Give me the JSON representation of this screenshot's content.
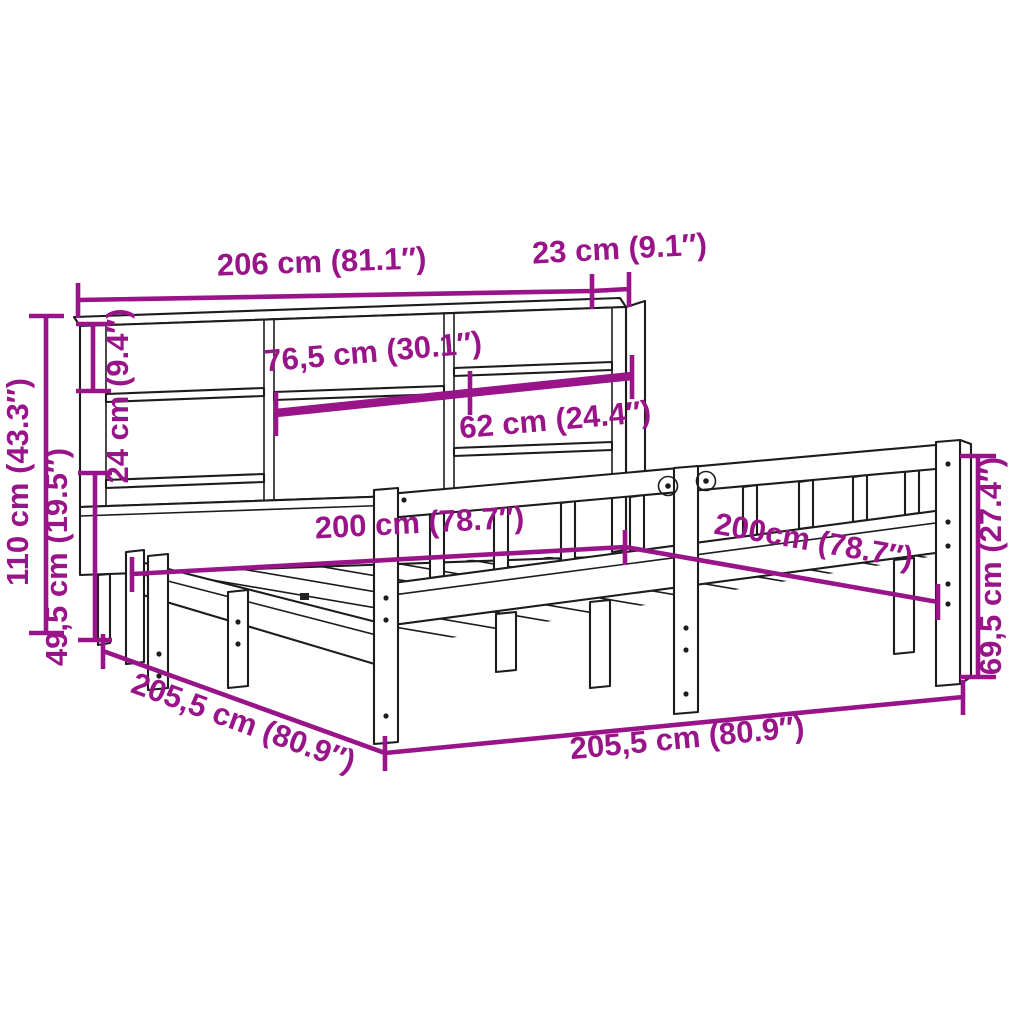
{
  "colors": {
    "background": "#ffffff",
    "outline": "#1c1c1c",
    "dimension": "#9a1489"
  },
  "dims": {
    "bookcase_width": {
      "label": "206 cm (81.1″)"
    },
    "bookcase_depth": {
      "label": "23 cm (9.1″)"
    },
    "shelf_middle_width": {
      "label": "76,5 cm (30.1″)"
    },
    "shelf_right_width": {
      "label": "62 cm (24.4″)"
    },
    "shelf_spacing_height": {
      "label": "24 cm (9.4″)"
    },
    "headboard_total_height": {
      "label": "110 cm (43.3″)"
    },
    "headboard_lower_height": {
      "label": "49,5 cm (19.5″)"
    },
    "mattress_width": {
      "label": "200 cm (78.7″)"
    },
    "mattress_length": {
      "label": "200cm (78.7″)"
    },
    "footboard_height": {
      "label": "69,5 cm (27.4″)"
    },
    "frame_side_length": {
      "label": "205,5 cm (80.9″)"
    },
    "frame_front_length": {
      "label": "205,5 cm (80.9″)"
    }
  }
}
